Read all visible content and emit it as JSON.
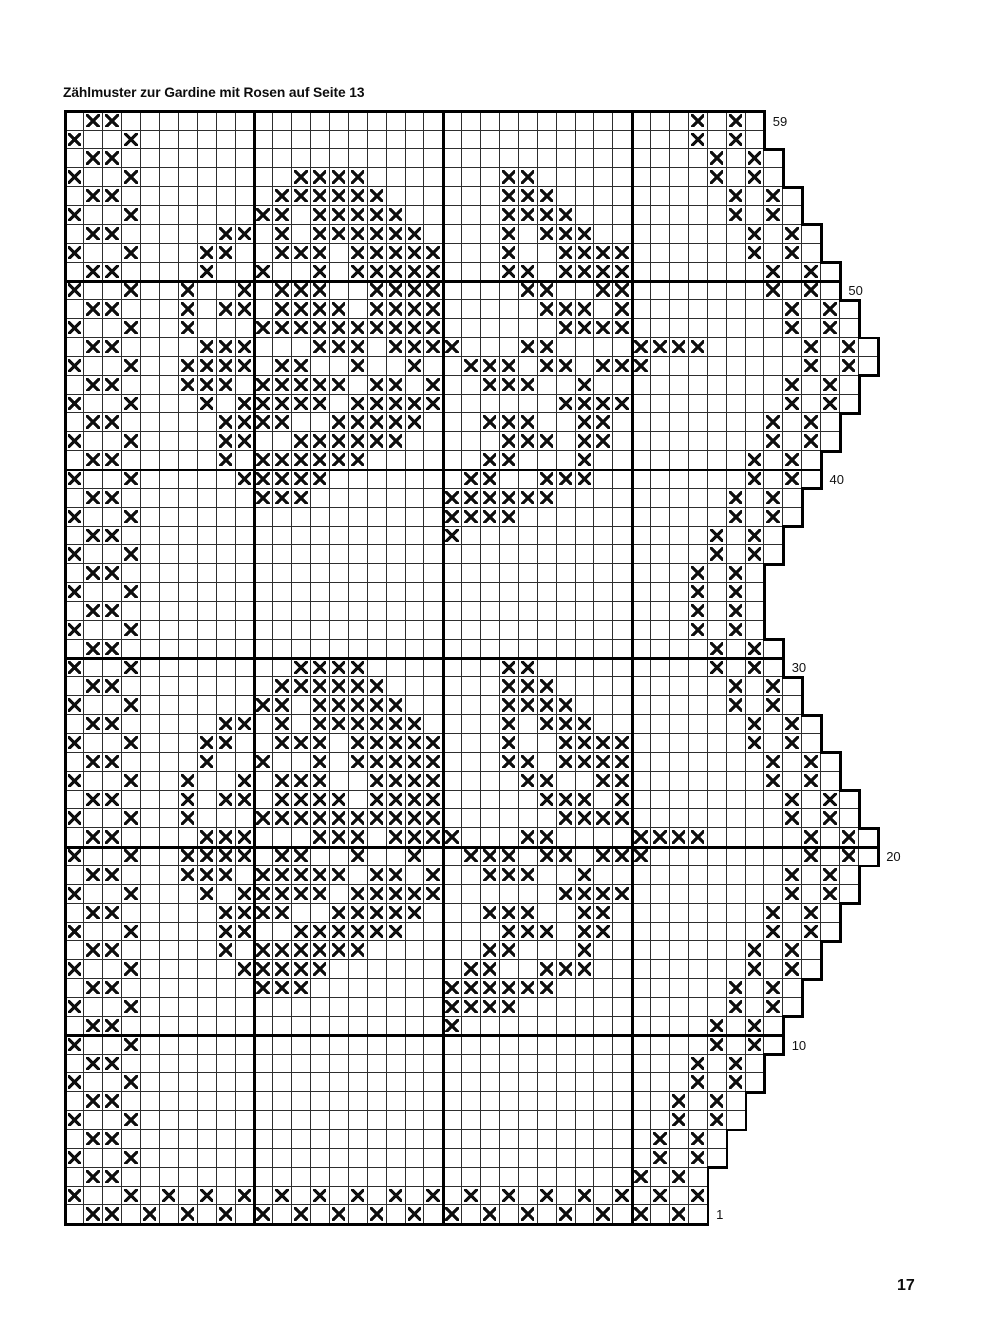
{
  "title": "Zählmuster zur Gardine mit Rosen auf Seite 13",
  "page_number": "17",
  "chart_data": {
    "type": "heatmap",
    "subtype": "filet-crochet-counting-grid",
    "description": "Counting pattern grid (Zählmuster) with X marks forming rose motifs; stepped right edge; bold guide lines every 10 squares; row numbers labeled on the right.",
    "colors": {
      "background": "#ffffff",
      "ink": "#0e0e0e",
      "thin_grid_line": "#2e2e2e",
      "bold_grid_line": "#000000"
    },
    "grid": {
      "total_rows": 59,
      "max_cols": 43,
      "bold_line_every": 10
    },
    "rows": [
      {
        "num": 59,
        "width": 37,
        "label": "59",
        "x": [
          2,
          3,
          34,
          36
        ]
      },
      {
        "num": 58,
        "width": 37,
        "label": null,
        "x": [
          1,
          4,
          34,
          36
        ]
      },
      {
        "num": 57,
        "width": 38,
        "label": null,
        "x": [
          2,
          3,
          35,
          37
        ]
      },
      {
        "num": 56,
        "width": 38,
        "label": null,
        "x": [
          1,
          4,
          13,
          14,
          15,
          16,
          24,
          25,
          35,
          37
        ]
      },
      {
        "num": 55,
        "width": 39,
        "label": null,
        "x": [
          2,
          3,
          12,
          13,
          14,
          15,
          16,
          17,
          24,
          25,
          26,
          36,
          38
        ]
      },
      {
        "num": 54,
        "width": 39,
        "label": null,
        "x": [
          1,
          4,
          11,
          12,
          14,
          15,
          16,
          17,
          18,
          24,
          25,
          26,
          27,
          36,
          38
        ]
      },
      {
        "num": 53,
        "width": 40,
        "label": null,
        "x": [
          2,
          3,
          9,
          10,
          12,
          14,
          15,
          16,
          17,
          18,
          19,
          24,
          26,
          27,
          28,
          37,
          39
        ]
      },
      {
        "num": 52,
        "width": 40,
        "label": null,
        "x": [
          1,
          4,
          8,
          9,
          12,
          13,
          14,
          16,
          17,
          18,
          19,
          20,
          24,
          27,
          28,
          29,
          30,
          37,
          39
        ]
      },
      {
        "num": 51,
        "width": 41,
        "label": null,
        "x": [
          2,
          3,
          8,
          11,
          14,
          16,
          17,
          18,
          19,
          20,
          24,
          25,
          27,
          28,
          29,
          30,
          38,
          40
        ]
      },
      {
        "num": 50,
        "width": 41,
        "label": "50",
        "x": [
          1,
          4,
          7,
          10,
          12,
          13,
          14,
          17,
          18,
          19,
          20,
          25,
          26,
          29,
          30,
          38,
          40
        ]
      },
      {
        "num": 49,
        "width": 42,
        "label": null,
        "x": [
          2,
          3,
          7,
          9,
          10,
          12,
          13,
          14,
          15,
          17,
          18,
          19,
          20,
          26,
          27,
          28,
          30,
          39,
          41
        ]
      },
      {
        "num": 48,
        "width": 42,
        "label": null,
        "x": [
          1,
          4,
          7,
          11,
          12,
          13,
          14,
          15,
          16,
          17,
          18,
          19,
          20,
          27,
          28,
          29,
          30,
          39,
          41
        ]
      },
      {
        "num": 47,
        "width": 43,
        "label": null,
        "x": [
          2,
          3,
          8,
          9,
          10,
          14,
          15,
          16,
          18,
          19,
          20,
          21,
          25,
          26,
          31,
          32,
          33,
          34,
          40,
          42
        ]
      },
      {
        "num": 46,
        "width": 43,
        "label": null,
        "x": [
          1,
          4,
          7,
          8,
          9,
          10,
          12,
          13,
          16,
          19,
          22,
          23,
          24,
          26,
          27,
          29,
          30,
          31,
          40,
          42
        ]
      },
      {
        "num": 45,
        "width": 42,
        "label": null,
        "x": [
          2,
          3,
          7,
          8,
          9,
          11,
          12,
          13,
          14,
          15,
          17,
          18,
          20,
          23,
          24,
          25,
          28,
          39,
          41
        ]
      },
      {
        "num": 44,
        "width": 42,
        "label": null,
        "x": [
          1,
          4,
          8,
          10,
          11,
          12,
          13,
          14,
          16,
          17,
          18,
          19,
          20,
          27,
          28,
          29,
          30,
          39,
          41
        ]
      },
      {
        "num": 43,
        "width": 41,
        "label": null,
        "x": [
          2,
          3,
          9,
          10,
          11,
          12,
          15,
          16,
          17,
          18,
          19,
          23,
          24,
          25,
          28,
          29,
          38,
          40
        ]
      },
      {
        "num": 42,
        "width": 41,
        "label": null,
        "x": [
          1,
          4,
          9,
          10,
          13,
          14,
          15,
          16,
          17,
          18,
          24,
          25,
          26,
          28,
          29,
          38,
          40
        ]
      },
      {
        "num": 41,
        "width": 40,
        "label": null,
        "x": [
          2,
          3,
          9,
          11,
          12,
          13,
          14,
          15,
          16,
          23,
          24,
          28,
          37,
          39
        ]
      },
      {
        "num": 40,
        "width": 40,
        "label": "40",
        "x": [
          1,
          4,
          10,
          11,
          12,
          13,
          14,
          22,
          23,
          26,
          27,
          28,
          37,
          39
        ]
      },
      {
        "num": 39,
        "width": 39,
        "label": null,
        "x": [
          2,
          3,
          11,
          12,
          13,
          21,
          22,
          23,
          24,
          25,
          26,
          36,
          38
        ]
      },
      {
        "num": 38,
        "width": 39,
        "label": null,
        "x": [
          1,
          4,
          21,
          22,
          23,
          24,
          36,
          38
        ]
      },
      {
        "num": 37,
        "width": 38,
        "label": null,
        "x": [
          2,
          3,
          21,
          35,
          37
        ]
      },
      {
        "num": 36,
        "width": 38,
        "label": null,
        "x": [
          1,
          4,
          35,
          37
        ]
      },
      {
        "num": 35,
        "width": 37,
        "label": null,
        "x": [
          2,
          3,
          34,
          36
        ]
      },
      {
        "num": 34,
        "width": 37,
        "label": null,
        "x": [
          1,
          4,
          34,
          36
        ]
      },
      {
        "num": 33,
        "width": 37,
        "label": null,
        "x": [
          2,
          3,
          34,
          36
        ]
      },
      {
        "num": 32,
        "width": 37,
        "label": null,
        "x": [
          1,
          4,
          34,
          36
        ]
      },
      {
        "num": 31,
        "width": 38,
        "label": null,
        "x": [
          2,
          3,
          35,
          37
        ]
      },
      {
        "num": 30,
        "width": 38,
        "label": "30",
        "x": [
          1,
          4,
          13,
          14,
          15,
          16,
          24,
          25,
          35,
          37
        ]
      },
      {
        "num": 29,
        "width": 39,
        "label": null,
        "x": [
          2,
          3,
          12,
          13,
          14,
          15,
          16,
          17,
          24,
          25,
          26,
          36,
          38
        ]
      },
      {
        "num": 28,
        "width": 39,
        "label": null,
        "x": [
          1,
          4,
          11,
          12,
          14,
          15,
          16,
          17,
          18,
          24,
          25,
          26,
          27,
          36,
          38
        ]
      },
      {
        "num": 27,
        "width": 40,
        "label": null,
        "x": [
          2,
          3,
          9,
          10,
          12,
          14,
          15,
          16,
          17,
          18,
          19,
          24,
          26,
          27,
          28,
          37,
          39
        ]
      },
      {
        "num": 26,
        "width": 40,
        "label": null,
        "x": [
          1,
          4,
          8,
          9,
          12,
          13,
          14,
          16,
          17,
          18,
          19,
          20,
          24,
          27,
          28,
          29,
          30,
          37,
          39
        ]
      },
      {
        "num": 25,
        "width": 41,
        "label": null,
        "x": [
          2,
          3,
          8,
          11,
          14,
          16,
          17,
          18,
          19,
          20,
          24,
          25,
          27,
          28,
          29,
          30,
          38,
          40
        ]
      },
      {
        "num": 24,
        "width": 41,
        "label": null,
        "x": [
          1,
          4,
          7,
          10,
          12,
          13,
          14,
          17,
          18,
          19,
          20,
          25,
          26,
          29,
          30,
          38,
          40
        ]
      },
      {
        "num": 23,
        "width": 42,
        "label": null,
        "x": [
          2,
          3,
          7,
          9,
          10,
          12,
          13,
          14,
          15,
          17,
          18,
          19,
          20,
          26,
          27,
          28,
          30,
          39,
          41
        ]
      },
      {
        "num": 22,
        "width": 42,
        "label": null,
        "x": [
          1,
          4,
          7,
          11,
          12,
          13,
          14,
          15,
          16,
          17,
          18,
          19,
          20,
          27,
          28,
          29,
          30,
          39,
          41
        ]
      },
      {
        "num": 21,
        "width": 43,
        "label": null,
        "x": [
          2,
          3,
          8,
          9,
          10,
          14,
          15,
          16,
          18,
          19,
          20,
          21,
          25,
          26,
          31,
          32,
          33,
          34,
          40,
          42
        ]
      },
      {
        "num": 20,
        "width": 43,
        "label": "20",
        "x": [
          1,
          4,
          7,
          8,
          9,
          10,
          12,
          13,
          16,
          19,
          22,
          23,
          24,
          26,
          27,
          29,
          30,
          31,
          40,
          42
        ]
      },
      {
        "num": 19,
        "width": 42,
        "label": null,
        "x": [
          2,
          3,
          7,
          8,
          9,
          11,
          12,
          13,
          14,
          15,
          17,
          18,
          20,
          23,
          24,
          25,
          28,
          39,
          41
        ]
      },
      {
        "num": 18,
        "width": 42,
        "label": null,
        "x": [
          1,
          4,
          8,
          10,
          11,
          12,
          13,
          14,
          16,
          17,
          18,
          19,
          20,
          27,
          28,
          29,
          30,
          39,
          41
        ]
      },
      {
        "num": 17,
        "width": 41,
        "label": null,
        "x": [
          2,
          3,
          9,
          10,
          11,
          12,
          15,
          16,
          17,
          18,
          19,
          23,
          24,
          25,
          28,
          29,
          38,
          40
        ]
      },
      {
        "num": 16,
        "width": 41,
        "label": null,
        "x": [
          1,
          4,
          9,
          10,
          13,
          14,
          15,
          16,
          17,
          18,
          24,
          25,
          26,
          28,
          29,
          38,
          40
        ]
      },
      {
        "num": 15,
        "width": 40,
        "label": null,
        "x": [
          2,
          3,
          9,
          11,
          12,
          13,
          14,
          15,
          16,
          23,
          24,
          28,
          37,
          39
        ]
      },
      {
        "num": 14,
        "width": 40,
        "label": null,
        "x": [
          1,
          4,
          10,
          11,
          12,
          13,
          14,
          22,
          23,
          26,
          27,
          28,
          37,
          39
        ]
      },
      {
        "num": 13,
        "width": 39,
        "label": null,
        "x": [
          2,
          3,
          11,
          12,
          13,
          21,
          22,
          23,
          24,
          25,
          26,
          36,
          38
        ]
      },
      {
        "num": 12,
        "width": 39,
        "label": null,
        "x": [
          1,
          4,
          21,
          22,
          23,
          24,
          36,
          38
        ]
      },
      {
        "num": 11,
        "width": 38,
        "label": null,
        "x": [
          2,
          3,
          21,
          35,
          37
        ]
      },
      {
        "num": 10,
        "width": 38,
        "label": "10",
        "x": [
          1,
          4,
          35,
          37
        ]
      },
      {
        "num": 9,
        "width": 37,
        "label": null,
        "x": [
          2,
          3,
          34,
          36
        ]
      },
      {
        "num": 8,
        "width": 37,
        "label": null,
        "x": [
          1,
          4,
          34,
          36
        ]
      },
      {
        "num": 7,
        "width": 36,
        "label": null,
        "x": [
          2,
          3,
          33,
          35
        ]
      },
      {
        "num": 6,
        "width": 36,
        "label": null,
        "x": [
          1,
          4,
          33,
          35
        ]
      },
      {
        "num": 5,
        "width": 35,
        "label": null,
        "x": [
          2,
          3,
          32,
          34
        ]
      },
      {
        "num": 4,
        "width": 35,
        "label": null,
        "x": [
          1,
          4,
          32,
          34
        ]
      },
      {
        "num": 3,
        "width": 34,
        "label": null,
        "x": [
          2,
          3,
          31,
          33
        ]
      },
      {
        "num": 2,
        "width": 34,
        "label": null,
        "x": [
          1,
          4,
          6,
          8,
          10,
          12,
          14,
          16,
          18,
          20,
          22,
          24,
          26,
          28,
          30,
          32,
          34
        ]
      },
      {
        "num": 1,
        "width": 34,
        "label": "1",
        "x": [
          2,
          3,
          5,
          7,
          9,
          11,
          13,
          15,
          17,
          19,
          21,
          23,
          25,
          27,
          29,
          31,
          33
        ]
      }
    ]
  }
}
